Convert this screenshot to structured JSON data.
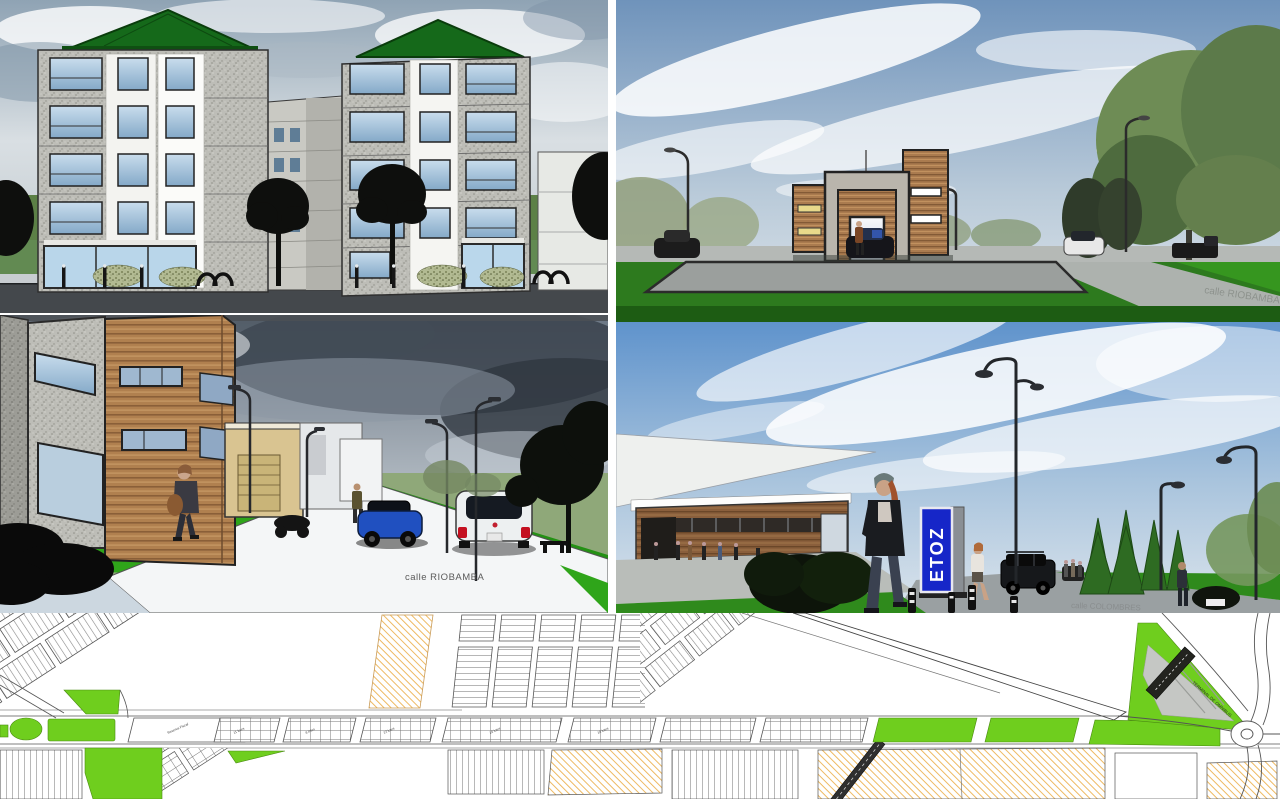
{
  "labels": {
    "street_ml": "calle RIOBAMBA",
    "street_tr": "calle RIOBAMBA",
    "street_mr": "calle COLOMBRES",
    "sign_mr": "ETOZ",
    "terminal_map": "TERMINAL DE OMNIBUS",
    "blocks": [
      "Reserva Fiscal",
      "11 lotes",
      "8 lotes",
      "22 lotes",
      "16 lotes",
      "18 lotes"
    ]
  },
  "colors": {
    "map_green": "#6fce1e",
    "hatch_orange": "#e8a83e",
    "sign_blue": "#1626c8",
    "roof_green": "#15691a",
    "grass_bright": "#2fa51a",
    "sky_blue": "#5f93cc"
  }
}
